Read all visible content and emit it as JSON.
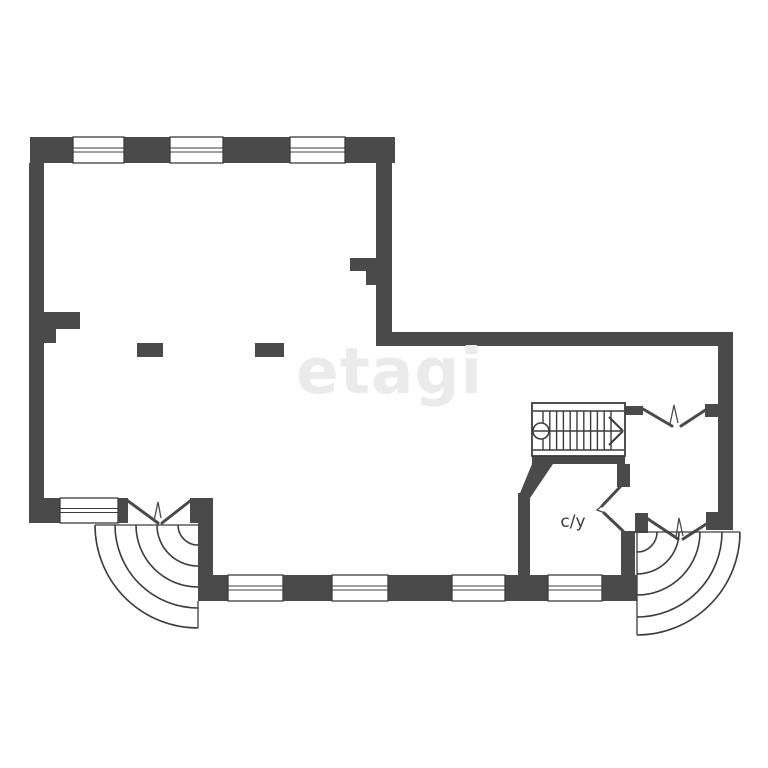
{
  "watermark": {
    "text": "etagi",
    "color": "#ebebeb"
  },
  "rooms": {
    "bathroom": {
      "label": "с/у",
      "color": "#3a3a3a"
    }
  },
  "colors": {
    "wall": "#4a4a4a",
    "line": "#3c3c3c",
    "background": "#ffffff"
  },
  "plan": {
    "canvas": {
      "width": 768,
      "height": 768
    },
    "walls": [
      [
        30,
        137,
        365,
        26
      ],
      [
        29,
        163,
        15,
        335
      ],
      [
        29,
        498,
        184,
        25
      ],
      [
        198,
        498,
        15,
        103
      ],
      [
        44,
        312,
        36,
        17
      ],
      [
        44,
        329,
        12,
        14
      ],
      [
        137,
        343,
        26,
        14
      ],
      [
        255,
        343,
        29,
        14
      ],
      [
        376,
        163,
        16,
        170
      ],
      [
        350,
        258,
        27,
        13
      ],
      [
        366,
        271,
        11,
        14
      ],
      [
        376,
        332,
        357,
        14
      ],
      [
        718,
        332,
        15,
        198
      ],
      [
        705,
        404,
        13,
        13
      ],
      [
        706,
        512,
        12,
        18
      ],
      [
        635,
        513,
        13,
        20
      ],
      [
        621,
        531,
        14,
        70
      ],
      [
        617,
        464,
        13,
        23
      ],
      [
        532,
        456,
        93,
        8
      ],
      [
        625,
        406,
        18,
        9
      ],
      [
        198,
        575,
        439,
        26
      ],
      [
        518,
        493,
        12,
        82
      ]
    ],
    "wall_polygons": [
      [
        [
          532,
          464
        ],
        [
          553,
          464
        ],
        [
          530,
          498
        ],
        [
          518,
          498
        ]
      ]
    ],
    "erase_openings": [
      [
        128,
        498,
        62,
        25
      ]
    ],
    "windows": [
      [
        73,
        137,
        51,
        26
      ],
      [
        170,
        137,
        53,
        26
      ],
      [
        290,
        137,
        55,
        26
      ],
      [
        60,
        498,
        58,
        25
      ],
      [
        228,
        575,
        55,
        26
      ],
      [
        332,
        575,
        56,
        26
      ],
      [
        452,
        575,
        53,
        26
      ],
      [
        548,
        575,
        54,
        26
      ]
    ],
    "door_openings": [
      {
        "lines": [
          [
            128,
            501,
            158,
            523
          ],
          [
            190,
            501,
            162,
            523
          ]
        ],
        "zigzag": [
          [
            154,
            521
          ],
          [
            158,
            502
          ],
          [
            161,
            518
          ]
        ]
      },
      {
        "lines": [
          [
            643,
            409,
            672,
            426
          ],
          [
            707,
            409,
            681,
            426
          ]
        ],
        "zigzag": [
          [
            670,
            424
          ],
          [
            674,
            405
          ],
          [
            678,
            423
          ]
        ]
      },
      {
        "lines": [
          [
            648,
            519,
            678,
            539
          ],
          [
            711,
            521,
            683,
            539
          ]
        ],
        "zigzag": [
          [
            676,
            537
          ],
          [
            679,
            518
          ],
          [
            683,
            536
          ]
        ]
      },
      {
        "lines": [
          [
            620,
            487,
            602,
            506
          ],
          [
            623,
            531,
            604,
            513
          ]
        ],
        "zigzag": [
          [
            604,
            504
          ],
          [
            597,
            510
          ],
          [
            605,
            513
          ]
        ]
      }
    ],
    "door_arc_fans": [
      {
        "center": [
          198,
          525
        ],
        "radii": [
          20,
          41,
          62,
          83,
          103
        ],
        "dir": "west",
        "lines": [
          [
            95,
            525,
            198,
            525
          ],
          [
            198,
            601,
            198,
            628
          ]
        ]
      },
      {
        "center": [
          637,
          532
        ],
        "radii": [
          20,
          42,
          63,
          85,
          103
        ],
        "dir": "east",
        "lines": [
          [
            637,
            532,
            740,
            532
          ],
          [
            637,
            532,
            637,
            635
          ]
        ]
      }
    ],
    "staircase": {
      "box": [
        532,
        403,
        93,
        53
      ],
      "inner_lines": [
        [
          533,
          411,
          624,
          411
        ],
        [
          533,
          450,
          624,
          450
        ]
      ],
      "steps": {
        "from": 543,
        "to": 611.5,
        "spacing": 6.8,
        "y1": 411,
        "y2": 450
      },
      "circle": [
        541,
        431,
        8
      ],
      "mid_line": [
        534,
        431,
        621,
        431
      ],
      "arrow": [
        [
          609,
          417,
          623,
          431
        ],
        [
          609,
          445,
          623,
          431
        ]
      ]
    }
  }
}
